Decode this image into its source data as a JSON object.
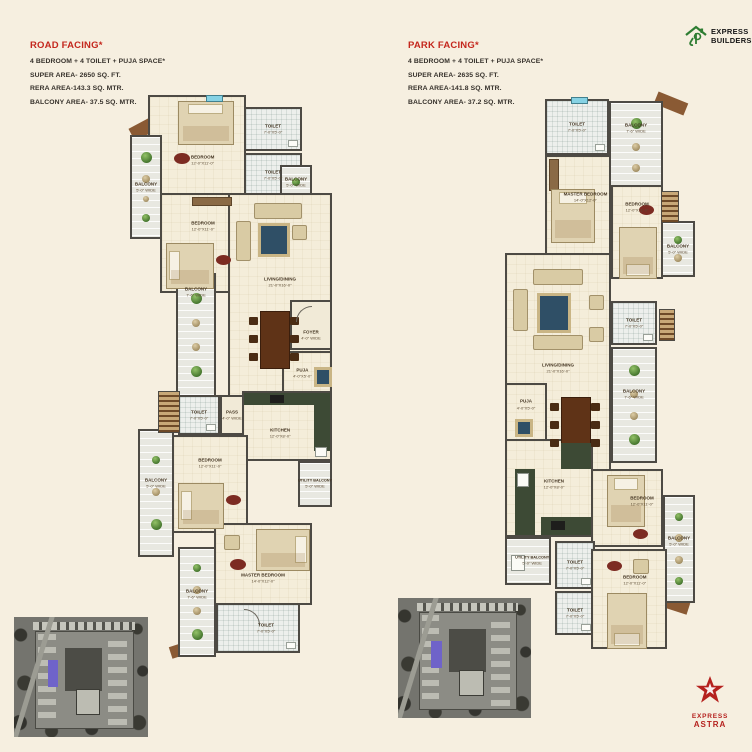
{
  "header_left": {
    "title": "ROAD FACING*",
    "subtitle": "4 BEDROOM + 4 TOILET + PUJA SPACE*",
    "super_area": "SUPER AREA- 2650 SQ. FT.",
    "rera_area": "RERA AREA-143.3 SQ. MTR.",
    "balcony_area": "BALCONY AREA- 37.5 SQ. MTR."
  },
  "header_right": {
    "title": "PARK FACING*",
    "subtitle": "4 BEDROOM + 4 TOILET + PUJA SPACE*",
    "super_area": "SUPER AREA- 2635 SQ. FT.",
    "rera_area": "RERA AREA-141.8 SQ. MTR.",
    "balcony_area": "BALCONY AREA- 37.2 SQ. MTR."
  },
  "logo_top": {
    "line1": "EXPRESS",
    "line2": "BUILDERS"
  },
  "logo_bottom": {
    "line1": "EXPRESS",
    "line2": "ASTRA"
  },
  "colors": {
    "background": "#f6efe0",
    "accent_red": "#c4271d",
    "logo_green": "#2e7d32",
    "star_red": "#b5211e",
    "wall": "#4d4a44",
    "kitchen_counter": "#3d4a35"
  },
  "plans": {
    "left": {
      "rooms": {
        "bedroom_top": {
          "name": "BEDROOM",
          "dims": "12'-0\"X11'-0\""
        },
        "toilet_top_a": {
          "name": "TOILET",
          "dims": "7'-0\"X5'-0\""
        },
        "toilet_top_b": {
          "name": "TOILET",
          "dims": "7'-0\"X5'-0\""
        },
        "balcony_top_left": {
          "name": "BALCONY",
          "dims": "5'-0\" WIDE"
        },
        "balcony_top_right": {
          "name": "BALCONY",
          "dims": "5'-0\" WIDE"
        },
        "bedroom_mid": {
          "name": "BEDROOM",
          "dims": "12'-0\"X11'-0\""
        },
        "living": {
          "name": "LIVING/DINING",
          "dims": "21'-0\"X16'-0\""
        },
        "foyer": {
          "name": "FOYER",
          "dims": "4'-0\" WIDE"
        },
        "balcony_mid_left": {
          "name": "BALCONY",
          "dims": "7'-6\" WIDE"
        },
        "puja": {
          "name": "PUJA",
          "dims": "4'-0\"X5'-0\""
        },
        "pass": {
          "name": "PASS",
          "dims": "4'-0\" WIDE"
        },
        "toilet_mid": {
          "name": "TOILET",
          "dims": "7'-0\"X5'-0\""
        },
        "kitchen": {
          "name": "KITCHEN",
          "dims": "12'-0\"X8'-0\""
        },
        "utility": {
          "name": "UTILITY BALCONY",
          "dims": "5'-0\" WIDE"
        },
        "bedroom_low": {
          "name": "BEDROOM",
          "dims": "12'-0\"X11'-0\""
        },
        "balcony_low_left": {
          "name": "BALCONY",
          "dims": "5'-0\" WIDE"
        },
        "master": {
          "name": "MASTER BEDROOM",
          "dims": "14'-0\"X12'-0\""
        },
        "balcony_bottom": {
          "name": "BALCONY",
          "dims": "7'-6\" WIDE"
        },
        "toilet_bottom": {
          "name": "TOILET",
          "dims": "7'-0\"X5'-0\""
        }
      }
    },
    "right": {
      "rooms": {
        "toilet_top": {
          "name": "TOILET",
          "dims": "7'-0\"X5'-0\""
        },
        "balcony_top": {
          "name": "BALCONY",
          "dims": "7'-6\" WIDE"
        },
        "master": {
          "name": "MASTER BEDROOM",
          "dims": "14'-0\"X12'-0\""
        },
        "bedroom_upper": {
          "name": "BEDROOM",
          "dims": "12'-0\"X11'-0\""
        },
        "balcony_upper_right": {
          "name": "BALCONY",
          "dims": "5'-0\" WIDE"
        },
        "living": {
          "name": "LIVING/DINING",
          "dims": "21'-0\"X16'-0\""
        },
        "toilet_mid": {
          "name": "TOILET",
          "dims": "7'-0\"X5'-0\""
        },
        "balcony_mid_right": {
          "name": "BALCONY",
          "dims": "7'-6\" WIDE"
        },
        "puja": {
          "name": "PUJA",
          "dims": "4'-0\"X5'-0\""
        },
        "kitchen": {
          "name": "KITCHEN",
          "dims": "12'-0\"X8'-0\""
        },
        "utility": {
          "name": "UTILITY BALCONY",
          "dims": "5'-0\" WIDE"
        },
        "bedroom_mid": {
          "name": "BEDROOM",
          "dims": "12'-0\"X11'-0\""
        },
        "balcony_low_right": {
          "name": "BALCONY",
          "dims": "5'-0\" WIDE"
        },
        "toilet_low_a": {
          "name": "TOILET",
          "dims": "7'-0\"X5'-0\""
        },
        "toilet_low_b": {
          "name": "TOILET",
          "dims": "7'-0\"X5'-0\""
        },
        "bedroom_bottom": {
          "name": "BEDROOM",
          "dims": "12'-0\"X11'-0\""
        }
      }
    }
  }
}
